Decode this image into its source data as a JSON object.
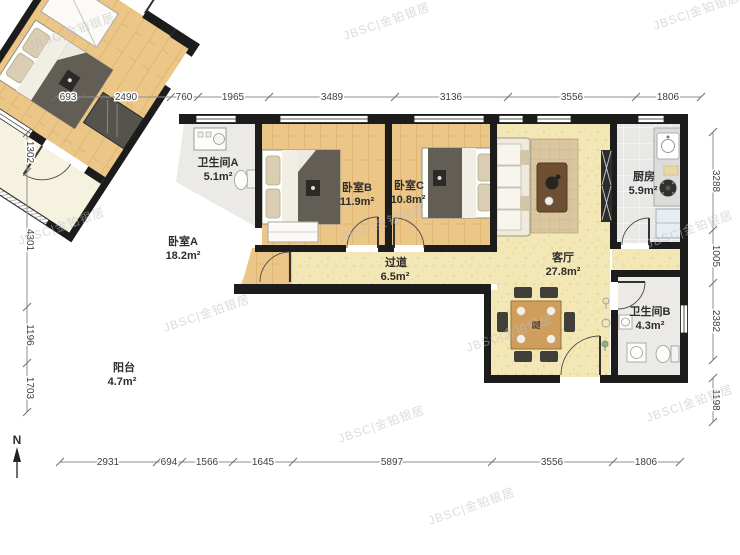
{
  "watermark": {
    "text": "JBSC|金铂银居"
  },
  "compass": {
    "label": "N"
  },
  "rooms": {
    "bathroom_a": {
      "name": "卫生间A",
      "area": "5.1m²"
    },
    "bedroom_b": {
      "name": "卧室B",
      "area": "11.9m²"
    },
    "bedroom_c": {
      "name": "卧室C",
      "area": "10.8m²"
    },
    "kitchen": {
      "name": "厨房",
      "area": "5.9m²"
    },
    "living_room": {
      "name": "客厅",
      "area": "27.8m²"
    },
    "hallway": {
      "name": "过道",
      "area": "6.5m²"
    },
    "bedroom_a": {
      "name": "卧室A",
      "area": "18.2m²"
    },
    "bathroom_b": {
      "name": "卫生间B",
      "area": "4.3m²"
    },
    "balcony": {
      "name": "阳台",
      "area": "4.7m²"
    }
  },
  "dims": {
    "top": [
      "693",
      "2490",
      "760",
      "1965",
      "3489",
      "3136",
      "3556",
      "1806"
    ],
    "bottom": [
      "2931",
      "694",
      "1566",
      "1645",
      "5897",
      "3556",
      "1806"
    ],
    "left": [
      "1302",
      "4301",
      "1196",
      "1703"
    ],
    "right": [
      "3288",
      "1005",
      "2382",
      "1198"
    ]
  }
}
